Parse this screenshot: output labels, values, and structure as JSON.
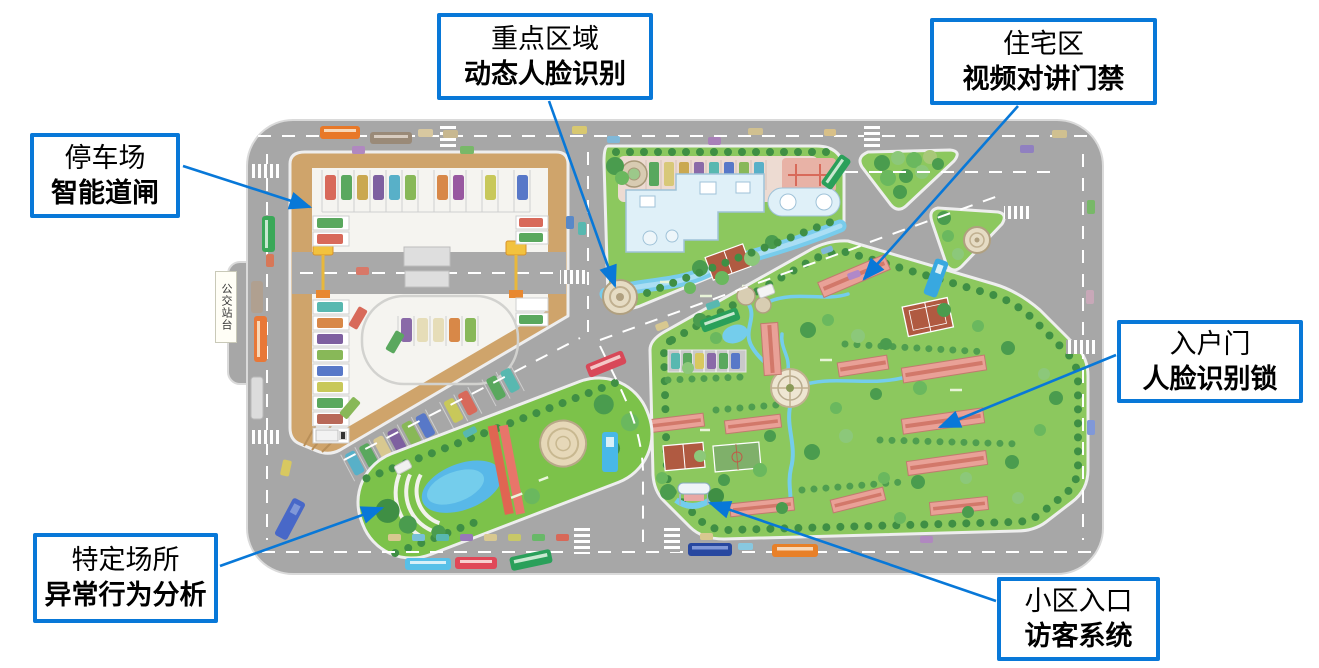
{
  "figure": {
    "type": "annotated-community-site-plan",
    "background": "#ffffff"
  },
  "colors": {
    "callout_border": "#0878d8",
    "arrow": "#0878d8",
    "road": "#a7a7a7",
    "block_green": "#8cc85e",
    "parking_tan": "#cfa46b",
    "building_pink": "#e9a197",
    "water_blue": "#74cdec"
  },
  "map": {
    "bus_stop_label": "公交站台"
  },
  "callouts": [
    {
      "id": "parking",
      "line1": "停车场",
      "line2": "智能道闸"
    },
    {
      "id": "key-area",
      "line1": "重点区域",
      "line2": "动态人脸识别"
    },
    {
      "id": "residential",
      "line1": "住宅区",
      "line2": "视频对讲门禁"
    },
    {
      "id": "entry-door",
      "line1": "入户门",
      "line2": "人脸识别锁"
    },
    {
      "id": "special-site",
      "line1": "特定场所",
      "line2": "异常行为分析"
    },
    {
      "id": "community-entrance",
      "line1": "小区入口",
      "line2": "访客系统"
    }
  ]
}
